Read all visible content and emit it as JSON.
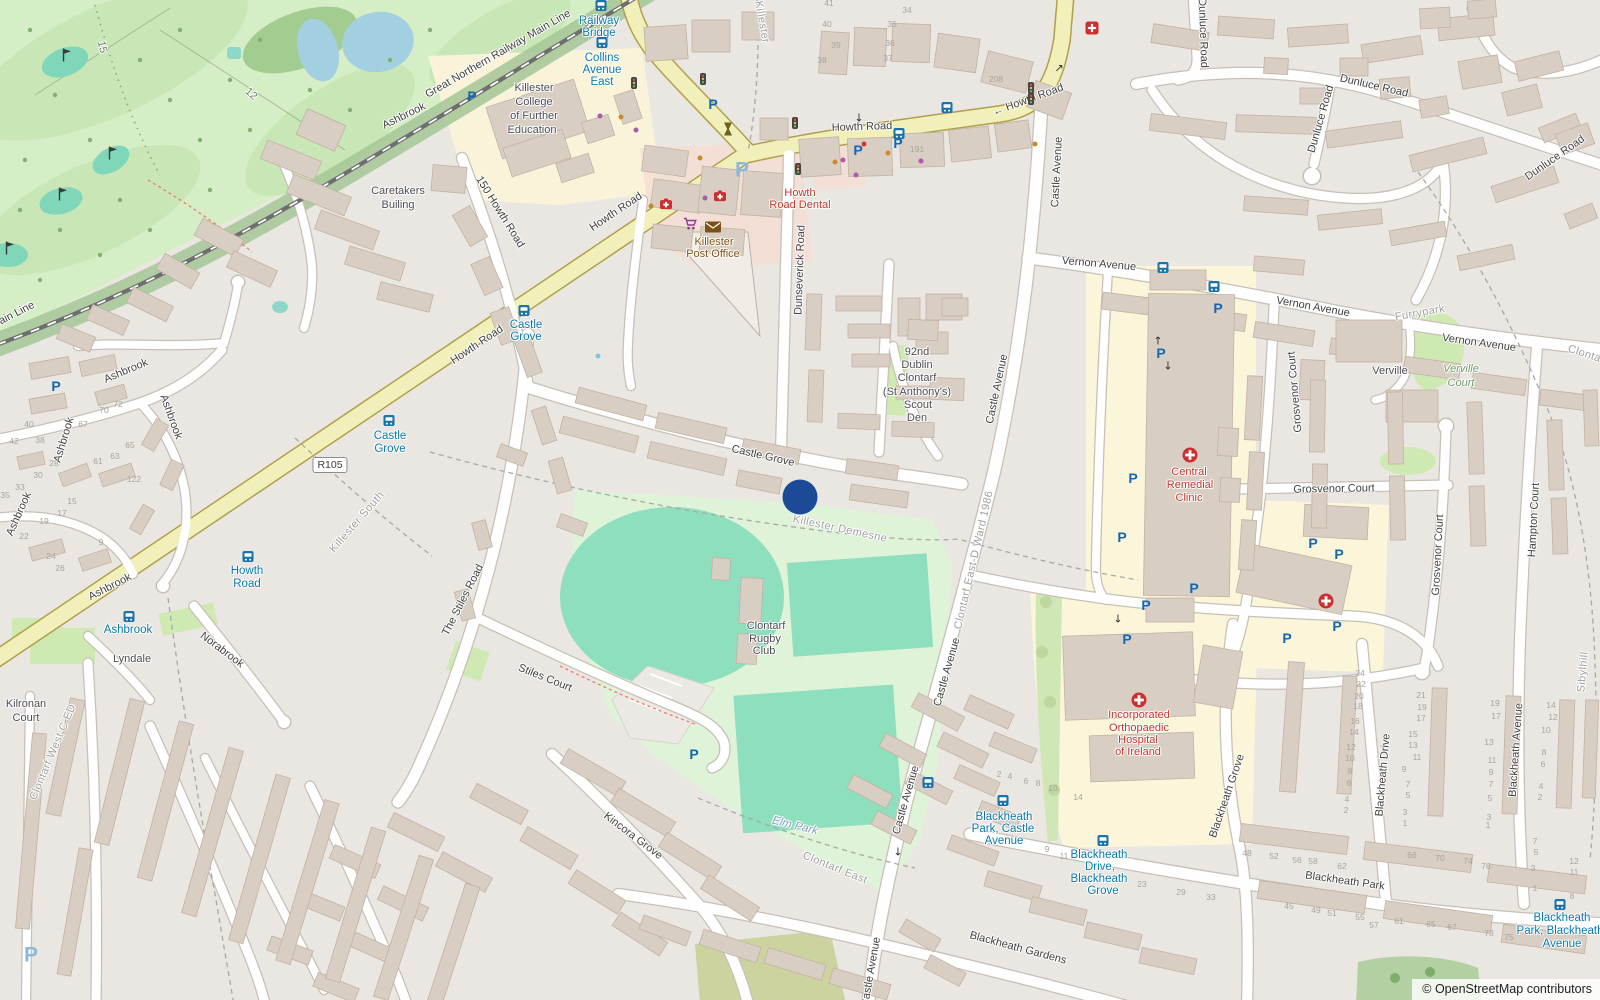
{
  "app": {
    "description": "OpenStreetMap map view of Killester / Clontarf, Dublin"
  },
  "attribution": {
    "prefix": "©",
    "link_text": "OpenStreetMap",
    "suffix": "contributors"
  },
  "marker": {
    "x": 800,
    "y": 497,
    "color": "#1c4a96"
  },
  "shield": {
    "text": "R105",
    "x": 330,
    "y": 465
  },
  "colors": {
    "background": "#eae7e2",
    "primary_road": "#f2f0ba",
    "primary_casing": "#b0a04a",
    "golf_green": "#d6eec6",
    "pitch_teal": "#8edfbe",
    "rugby_ground": "#def3d8",
    "campus_cream": "#fbf5da",
    "retail_pink": "#f6ddd3",
    "building": "#d9cec3",
    "water": "#a3d0e0",
    "transit_blue": "#0978ab",
    "medical_red": "#c5342a",
    "marker_blue": "#1c4a96"
  },
  "street_labels": [
    [
      "Great Northern Railway Main Line",
      498,
      54,
      -30
    ],
    [
      "Great Northern Railway Main Line",
      -40,
      342,
      -27
    ],
    [
      "150 Howth Road",
      500,
      212,
      58
    ],
    [
      "Howth Road",
      616,
      212,
      -34
    ],
    [
      "Howth Road",
      477,
      345,
      -34
    ],
    [
      "Howth Road",
      862,
      127,
      -2
    ],
    [
      "← Howth Road",
      1028,
      100,
      -20
    ],
    [
      "Castle Avenue",
      1057,
      172,
      -87
    ],
    [
      "Castle Avenue",
      997,
      389,
      -78
    ],
    [
      "Castle Avenue",
      947,
      672,
      -74
    ],
    [
      "Castle Avenue",
      906,
      800,
      -74
    ],
    [
      "Castle Avenue",
      871,
      972,
      -80
    ],
    [
      "Castle Grove",
      763,
      456,
      13
    ],
    [
      "Dunseverick Road",
      800,
      270,
      -88
    ],
    [
      "Vernon Avenue",
      1099,
      264,
      5
    ],
    [
      "Vernon Avenue",
      1313,
      307,
      10
    ],
    [
      "Vernon Avenue",
      1479,
      343,
      8
    ],
    [
      "Dunluce Road",
      1203,
      33,
      88
    ],
    [
      "Dunluce Road",
      1374,
      86,
      13
    ],
    [
      "Dunluce Road",
      1321,
      119,
      -74
    ],
    [
      "Dunluce Road",
      1555,
      158,
      -35
    ],
    [
      "Ashbrook",
      126,
      371,
      -23
    ],
    [
      "Ashbrook",
      171,
      417,
      70
    ],
    [
      "Ashbrook",
      64,
      440,
      -73
    ],
    [
      "Ashbrook",
      19,
      514,
      -66
    ],
    [
      "Ashbrook",
      110,
      587,
      -27
    ],
    [
      "Ashbrook",
      404,
      116,
      -26
    ],
    [
      "Norabrook",
      222,
      650,
      37
    ],
    [
      "The Stiles Road",
      463,
      600,
      -63
    ],
    [
      "Stiles Court",
      545,
      678,
      22
    ],
    [
      "Kincora Grove",
      633,
      836,
      37
    ],
    [
      "Grosvenor Court",
      1295,
      392,
      -95
    ],
    [
      "Grosvenor Court",
      1334,
      489,
      -1
    ],
    [
      "Grosvenor Court",
      1438,
      555,
      -87
    ],
    [
      "Hampton Court",
      1534,
      520,
      -87
    ],
    [
      "Blackheath Grove",
      1227,
      796,
      -71
    ],
    [
      "Blackheath Drive",
      1383,
      775,
      -85
    ],
    [
      "Blackheath Avenue",
      1516,
      750,
      -86
    ],
    [
      "Blackheath Park",
      1345,
      881,
      8
    ],
    [
      "Blackheath Gardens",
      1018,
      948,
      15
    ]
  ],
  "boundary_labels": [
    [
      "Killester",
      762,
      22,
      80
    ],
    [
      "Killester South",
      357,
      522,
      -49
    ],
    [
      "Killester Demesne",
      840,
      529,
      12
    ],
    [
      "Clontarf East",
      835,
      868,
      22
    ],
    [
      "Clontarf East-D Ward 1986",
      974,
      560,
      -77
    ],
    [
      "Clontarf West C ED",
      53,
      752,
      -67
    ],
    [
      "Furrypark",
      1420,
      313,
      -10
    ],
    [
      "Sibylhill",
      1583,
      672,
      -85
    ],
    [
      "Clontarf",
      1588,
      355,
      18
    ]
  ],
  "golf_hole_labels": [
    [
      "15",
      102,
      47,
      78
    ],
    [
      "12",
      251,
      94,
      42
    ]
  ],
  "place_labels": [
    [
      "Killester",
      534,
      88
    ],
    [
      "College",
      534,
      102
    ],
    [
      "of Further",
      534,
      116
    ],
    [
      "Education",
      532,
      130
    ],
    [
      "Caretakers",
      398,
      191
    ],
    [
      "Builing",
      398,
      205
    ],
    [
      "92nd",
      917,
      352
    ],
    [
      "Dublin",
      917,
      365
    ],
    [
      "Clontarf",
      917,
      378
    ],
    [
      "(St Anthony's)",
      917,
      392
    ],
    [
      "Scout",
      918,
      405
    ],
    [
      "Den",
      917,
      418
    ],
    [
      "Verville",
      1390,
      371
    ],
    [
      "Clontarf",
      766,
      626
    ],
    [
      "Rugby",
      765,
      639
    ],
    [
      "Club",
      764,
      651
    ],
    [
      "Kilronan",
      26,
      704
    ],
    [
      "Court",
      26,
      718
    ],
    [
      "Lyndale",
      132,
      659
    ]
  ],
  "medical_labels": [
    [
      "Howth",
      800,
      193
    ],
    [
      "Road Dental",
      800,
      205
    ],
    [
      "Central",
      1189,
      472
    ],
    [
      "Remedial",
      1190,
      485
    ],
    [
      "Clinic",
      1189,
      498
    ],
    [
      "Incorporated",
      1139,
      715
    ],
    [
      "Orthopaedic",
      1139,
      728
    ],
    [
      "Hospital",
      1138,
      740
    ],
    [
      "of Ireland",
      1138,
      752
    ]
  ],
  "post_office_labels": [
    [
      "Killester",
      714,
      242
    ],
    [
      "Post Office",
      713,
      254
    ]
  ],
  "green_labels": [
    [
      "Verville",
      1461,
      369
    ],
    [
      "Court",
      1461,
      383
    ]
  ],
  "park_labels": [
    [
      "Elm Park",
      795,
      826,
      14
    ]
  ],
  "transit_labels": [
    [
      "Railway",
      599,
      21
    ],
    [
      "Bridge",
      599,
      33
    ],
    [
      "Collins",
      602,
      58
    ],
    [
      "Avenue",
      602,
      70
    ],
    [
      "East",
      602,
      82
    ],
    [
      "Castle",
      526,
      325
    ],
    [
      "Grove",
      526,
      337
    ],
    [
      "Castle",
      390,
      436
    ],
    [
      "Grove",
      390,
      449
    ],
    [
      "Howth",
      247,
      571
    ],
    [
      "Road",
      247,
      584
    ],
    [
      "Ashbrook",
      128,
      630
    ],
    [
      "Blackheath",
      1004,
      817
    ],
    [
      "Park, Castle",
      1003,
      829
    ],
    [
      "Avenue",
      1004,
      841
    ],
    [
      "Blackheath",
      1099,
      855
    ],
    [
      "Drive,",
      1100,
      867
    ],
    [
      "Blackheath",
      1099,
      879
    ],
    [
      "Grove",
      1103,
      891
    ],
    [
      "Blackheath",
      1562,
      918
    ],
    [
      "Park, Blackheath",
      1560,
      931
    ],
    [
      "Avenue",
      1562,
      944
    ]
  ],
  "house_numbers": [
    [
      "70",
      104,
      410
    ],
    [
      "72",
      118,
      404
    ],
    [
      "67",
      83,
      424
    ],
    [
      "65",
      130,
      445
    ],
    [
      "63",
      115,
      456
    ],
    [
      "61",
      98,
      461
    ],
    [
      "122",
      134,
      479
    ],
    [
      "40",
      29,
      424
    ],
    [
      "42",
      14,
      441
    ],
    [
      "38",
      40,
      440
    ],
    [
      "28",
      54,
      463
    ],
    [
      "30",
      38,
      475
    ],
    [
      "33",
      20,
      487
    ],
    [
      "35",
      5,
      495
    ],
    [
      "15",
      72,
      501
    ],
    [
      "17",
      62,
      513
    ],
    [
      "19",
      44,
      521
    ],
    [
      "22",
      24,
      536
    ],
    [
      "24",
      51,
      556
    ],
    [
      "26",
      60,
      568
    ],
    [
      "9",
      101,
      542
    ],
    [
      "41",
      829,
      3
    ],
    [
      "40",
      827,
      24
    ],
    [
      "39",
      836,
      45
    ],
    [
      "38",
      822,
      60
    ],
    [
      "34",
      907,
      10
    ],
    [
      "35",
      892,
      24
    ],
    [
      "36",
      890,
      43
    ],
    [
      "37",
      888,
      58
    ],
    [
      "208",
      996,
      79
    ],
    [
      "191",
      917,
      149
    ],
    [
      "2",
      999,
      774
    ],
    [
      "4",
      1010,
      776
    ],
    [
      "6",
      1026,
      781
    ],
    [
      "8",
      1038,
      783
    ],
    [
      "10",
      1053,
      788
    ],
    [
      "14",
      1078,
      797
    ],
    [
      "9",
      1047,
      849
    ],
    [
      "11",
      1064,
      856
    ],
    [
      "23",
      1142,
      884
    ],
    [
      "29",
      1181,
      892
    ],
    [
      "33",
      1211,
      897
    ],
    [
      "48",
      1247,
      853
    ],
    [
      "52",
      1274,
      856
    ],
    [
      "56",
      1297,
      860
    ],
    [
      "58",
      1313,
      861
    ],
    [
      "62",
      1342,
      866
    ],
    [
      "24",
      1360,
      673
    ],
    [
      "22",
      1361,
      684
    ],
    [
      "20",
      1359,
      696
    ],
    [
      "18",
      1358,
      706
    ],
    [
      "16",
      1355,
      721
    ],
    [
      "14",
      1354,
      732
    ],
    [
      "12",
      1351,
      747
    ],
    [
      "10",
      1350,
      758
    ],
    [
      "8",
      1350,
      771
    ],
    [
      "6",
      1349,
      783
    ],
    [
      "4",
      1347,
      799
    ],
    [
      "2",
      1346,
      810
    ],
    [
      "21",
      1421,
      695
    ],
    [
      "19",
      1422,
      707
    ],
    [
      "17",
      1421,
      718
    ],
    [
      "15",
      1413,
      734
    ],
    [
      "13",
      1413,
      745
    ],
    [
      "11",
      1417,
      757
    ],
    [
      "9",
      1404,
      769
    ],
    [
      "7",
      1408,
      784
    ],
    [
      "5",
      1408,
      795
    ],
    [
      "3",
      1405,
      812
    ],
    [
      "1",
      1405,
      823
    ],
    [
      "66",
      1412,
      855
    ],
    [
      "70",
      1440,
      858
    ],
    [
      "74",
      1468,
      861
    ],
    [
      "76",
      1486,
      866
    ],
    [
      "19",
      1495,
      703
    ],
    [
      "17",
      1496,
      716
    ],
    [
      "13",
      1489,
      742
    ],
    [
      "11",
      1492,
      760
    ],
    [
      "9",
      1491,
      772
    ],
    [
      "7",
      1491,
      784
    ],
    [
      "5",
      1490,
      798
    ],
    [
      "3",
      1489,
      817
    ],
    [
      "1",
      1488,
      825
    ],
    [
      "14",
      1551,
      705
    ],
    [
      "12",
      1553,
      717
    ],
    [
      "10",
      1546,
      730
    ],
    [
      "8",
      1544,
      752
    ],
    [
      "6",
      1543,
      764
    ],
    [
      "4",
      1541,
      786
    ],
    [
      "2",
      1540,
      797
    ],
    [
      "7",
      1535,
      841
    ],
    [
      "5",
      1536,
      852
    ],
    [
      "3",
      1533,
      868
    ],
    [
      "1",
      1535,
      888
    ],
    [
      "12",
      1574,
      861
    ],
    [
      "11",
      1574,
      872
    ],
    [
      "8",
      1572,
      896
    ],
    [
      "45",
      1289,
      906
    ],
    [
      "49",
      1316,
      910
    ],
    [
      "51",
      1332,
      913
    ],
    [
      "55",
      1360,
      917
    ],
    [
      "57",
      1374,
      925
    ],
    [
      "61",
      1399,
      921
    ],
    [
      "65",
      1431,
      924
    ],
    [
      "67",
      1452,
      927
    ],
    [
      "73",
      1489,
      933
    ],
    [
      "75",
      1509,
      937
    ]
  ],
  "icons": [
    [
      "bus",
      601,
      6
    ],
    [
      "bus",
      602,
      43
    ],
    [
      "bus",
      947,
      108
    ],
    [
      "bus",
      899,
      134
    ],
    [
      "bus",
      524,
      311
    ],
    [
      "bus",
      389,
      421
    ],
    [
      "bus",
      248,
      557
    ],
    [
      "bus",
      129,
      617
    ],
    [
      "bus",
      1163,
      268
    ],
    [
      "bus",
      1214,
      287
    ],
    [
      "bus",
      928,
      783
    ],
    [
      "bus",
      1003,
      801
    ],
    [
      "bus",
      1103,
      841
    ],
    [
      "bus",
      1560,
      905
    ],
    [
      "p",
      472,
      96
    ],
    [
      "p",
      713,
      104
    ],
    [
      "p",
      56,
      386
    ],
    [
      "p",
      858,
      150
    ],
    [
      "p",
      898,
      143
    ],
    [
      "p",
      1218,
      308
    ],
    [
      "p",
      1161,
      353
    ],
    [
      "p",
      1133,
      478
    ],
    [
      "p",
      1122,
      537
    ],
    [
      "p",
      1194,
      588
    ],
    [
      "p",
      1146,
      605
    ],
    [
      "p",
      1127,
      639
    ],
    [
      "p",
      1337,
      626
    ],
    [
      "p",
      1287,
      638
    ],
    [
      "p",
      1339,
      554
    ],
    [
      "p",
      1313,
      543
    ],
    [
      "p",
      694,
      754
    ],
    [
      "p-light",
      742,
      170
    ],
    [
      "p-light",
      31,
      955
    ],
    [
      "medic",
      1190,
      455
    ],
    [
      "medic",
      1326,
      601
    ],
    [
      "medic",
      1139,
      700
    ],
    [
      "pharm",
      1092,
      28
    ],
    [
      "case",
      666,
      204
    ],
    [
      "case",
      720,
      196
    ],
    [
      "mail",
      713,
      227
    ],
    [
      "cart",
      690,
      224
    ],
    [
      "levelx",
      728,
      129
    ],
    [
      "signal",
      634,
      83
    ],
    [
      "signal",
      703,
      79
    ],
    [
      "signal",
      795,
      123
    ],
    [
      "signal",
      798,
      169
    ],
    [
      "signal",
      1031,
      88
    ],
    [
      "signal",
      1031,
      99
    ],
    [
      "arrow",
      1059,
      68,
      "↗"
    ],
    [
      "arrow",
      859,
      118,
      "↓"
    ],
    [
      "arrow",
      1158,
      341,
      "↑"
    ],
    [
      "arrow",
      1168,
      366,
      "↓"
    ],
    [
      "arrow",
      1118,
      619,
      "↓"
    ],
    [
      "arrow",
      898,
      852,
      "↓"
    ],
    [
      "flag",
      67,
      55
    ],
    [
      "flag",
      113,
      153
    ],
    [
      "flag",
      63,
      194
    ],
    [
      "flag",
      10,
      248
    ],
    [
      "dot",
      600,
      116,
      "#a95ca8"
    ],
    [
      "dot",
      636,
      130,
      "#a95ca8"
    ],
    [
      "dot",
      705,
      198,
      "#a95ca8"
    ],
    [
      "dot",
      843,
      160,
      "#a95ca8"
    ],
    [
      "dot",
      856,
      175,
      "#a95ca8"
    ],
    [
      "dot",
      921,
      161,
      "#a95ca8"
    ],
    [
      "dot",
      621,
      117,
      "#c98a2e"
    ],
    [
      "dot",
      835,
      162,
      "#c98a2e"
    ],
    [
      "dot",
      888,
      153,
      "#c98a2e"
    ],
    [
      "dot",
      1035,
      144,
      "#c98a2e"
    ],
    [
      "dot",
      700,
      158,
      "#c98a2e"
    ],
    [
      "dot",
      651,
      206,
      "#c98a2e"
    ],
    [
      "dot",
      864,
      144,
      "#cc4125"
    ],
    [
      "dot",
      598,
      356,
      "#7fc4e8"
    ]
  ]
}
